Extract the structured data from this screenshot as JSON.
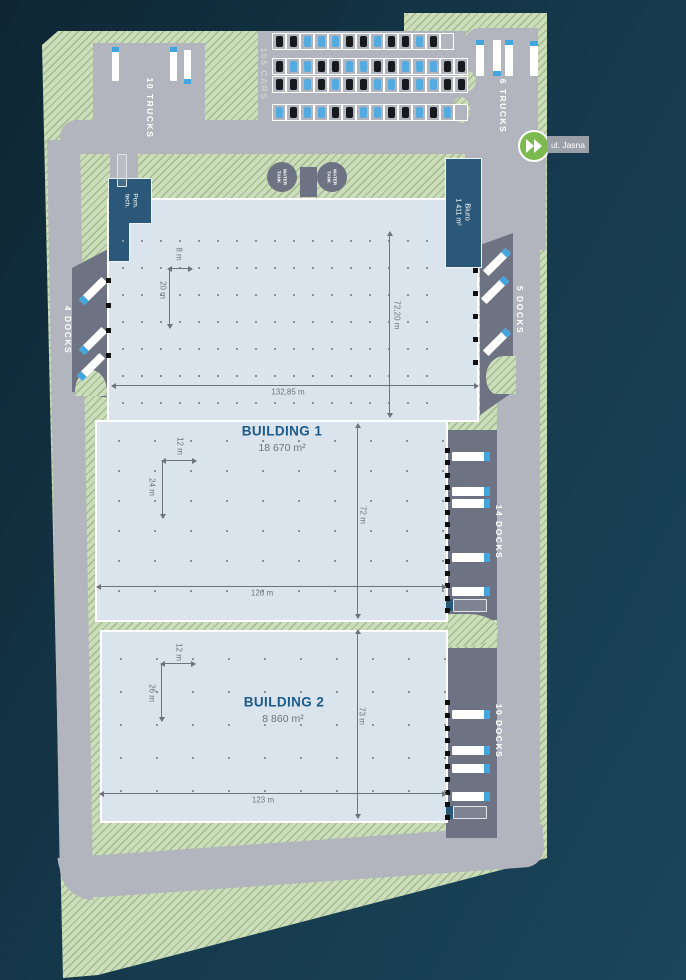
{
  "site": {
    "labels": {
      "trucks_top": "10 TRUCKS",
      "cars_count": "105 CARS",
      "trucks_right": "6 TRUCKS",
      "docks_left": "4 DOCKS",
      "docks_upper_right": "5 DOCKS",
      "docks_mid_right": "14 DOCKS",
      "docks_lower_right": "10 DOCKS",
      "street": "ul. Jasna",
      "water_tank": "WATER TANK",
      "tech_room_line1": "Pom.",
      "tech_room_line2": "tech.",
      "office_name": "Biuro",
      "office_area": "1 411 m²"
    },
    "buildings": [
      {
        "name": "BUILDING 1",
        "area": "18 670 m²"
      },
      {
        "name": "BUILDING 2",
        "area": "8 860 m²"
      }
    ],
    "dimensions": {
      "b1_width": "132,85 m",
      "b1_depth": "72,20 m",
      "b1_lower_width": "126 m",
      "b1_lower_depth": "72 m",
      "b2_width": "123 m",
      "b2_depth": "73 m",
      "corner_w": "8 m",
      "corner_d": "20 m",
      "b1_bay_w": "12 m",
      "b1_bay_d": "24 m",
      "b2_bay_w": "12 m",
      "b2_bay_d": "26 m"
    },
    "parking": {
      "x": 272,
      "rows": [
        {
          "y": 33,
          "cars": [
            "black",
            "black",
            "blue",
            "blue",
            "blue",
            "black",
            "black",
            "blue",
            "black",
            "black",
            "blue",
            "black",
            "empty"
          ]
        },
        {
          "y": 58,
          "cars": [
            "black",
            "blue",
            "blue",
            "black",
            "black",
            "blue",
            "blue",
            "black",
            "black",
            "blue",
            "blue",
            "blue",
            "black",
            "black"
          ]
        },
        {
          "y": 76,
          "cars": [
            "black",
            "black",
            "blue",
            "black",
            "blue",
            "black",
            "black",
            "blue",
            "blue",
            "black",
            "blue",
            "blue",
            "black",
            "black"
          ]
        },
        {
          "y": 104,
          "cars": [
            "blue",
            "black",
            "blue",
            "blue",
            "black",
            "black",
            "blue",
            "blue",
            "black",
            "black",
            "blue",
            "black",
            "blue",
            "empty"
          ]
        }
      ]
    },
    "trucks": [
      {
        "x": 112,
        "y": 47,
        "w": 7,
        "h": 34,
        "cab": "top"
      },
      {
        "x": 170,
        "y": 47,
        "w": 7,
        "h": 34,
        "cab": "top"
      },
      {
        "x": 184,
        "y": 50,
        "w": 7,
        "h": 34,
        "cab": "bottom"
      },
      {
        "x": 476,
        "y": 40,
        "w": 8,
        "h": 36,
        "cab": "top"
      },
      {
        "x": 493,
        "y": 40,
        "w": 8,
        "h": 36,
        "cab": "bottom"
      },
      {
        "x": 505,
        "y": 40,
        "w": 8,
        "h": 36,
        "cab": "top"
      },
      {
        "x": 530,
        "y": 41,
        "w": 8,
        "h": 35,
        "cab": "top"
      },
      {
        "x": 117,
        "y": 154,
        "w": 10,
        "h": 33,
        "cab": "none",
        "style": "outline"
      },
      {
        "cx": 93,
        "cy": 291,
        "w": 32,
        "h": 8,
        "rot": -45,
        "cab": "left"
      },
      {
        "cx": 93,
        "cy": 341,
        "w": 32,
        "h": 8,
        "rot": -45,
        "cab": "left"
      },
      {
        "cx": 91,
        "cy": 367,
        "w": 32,
        "h": 8,
        "rot": -45,
        "cab": "left"
      },
      {
        "cx": 497,
        "cy": 262,
        "w": 32,
        "h": 8,
        "rot": -45,
        "cab": "right"
      },
      {
        "cx": 495,
        "cy": 290,
        "w": 32,
        "h": 8,
        "rot": -45,
        "cab": "right"
      },
      {
        "cx": 497,
        "cy": 342,
        "w": 32,
        "h": 8,
        "rot": -45,
        "cab": "right"
      },
      {
        "x": 452,
        "y": 452,
        "w": 38,
        "h": 9,
        "cab": "right"
      },
      {
        "x": 452,
        "y": 487,
        "w": 38,
        "h": 9,
        "cab": "right"
      },
      {
        "x": 452,
        "y": 499,
        "w": 38,
        "h": 9,
        "cab": "right"
      },
      {
        "x": 452,
        "y": 553,
        "w": 38,
        "h": 9,
        "cab": "right"
      },
      {
        "x": 452,
        "y": 587,
        "w": 38,
        "h": 9,
        "cab": "right"
      },
      {
        "x": 453,
        "y": 599,
        "w": 34,
        "h": 13,
        "cab": "none",
        "style": "outline"
      },
      {
        "x": 452,
        "y": 710,
        "w": 38,
        "h": 9,
        "cab": "right"
      },
      {
        "x": 452,
        "y": 746,
        "w": 38,
        "h": 9,
        "cab": "right"
      },
      {
        "x": 452,
        "y": 764,
        "w": 38,
        "h": 9,
        "cab": "right"
      },
      {
        "x": 452,
        "y": 792,
        "w": 38,
        "h": 9,
        "cab": "right"
      },
      {
        "x": 453,
        "y": 806,
        "w": 34,
        "h": 13,
        "cab": "none",
        "style": "outline"
      }
    ],
    "dock_doors": [
      {
        "x": 106,
        "y0": 278,
        "n": 4,
        "dy": 25
      },
      {
        "x": 473,
        "y0": 268,
        "n": 5,
        "dy": 23
      },
      {
        "x": 445,
        "y0": 448,
        "n": 14,
        "dy": 12.3
      },
      {
        "x": 445,
        "y0": 700,
        "n": 10,
        "dy": 12.8
      }
    ],
    "colors": {
      "background": "#163a4e",
      "greenery": "#ccddbc",
      "road": "#b2b4be",
      "dock_apron": "#6d7382",
      "building_floor": "#d9e4ec",
      "office_block": "#2b5878",
      "building_title": "#1d5a8c",
      "truck_cab": "#42a5dd",
      "car_black": "#17191c",
      "car_blue": "#54abe0",
      "entrance_marker": "#7cb94f",
      "dimension": "#6f747c"
    }
  }
}
